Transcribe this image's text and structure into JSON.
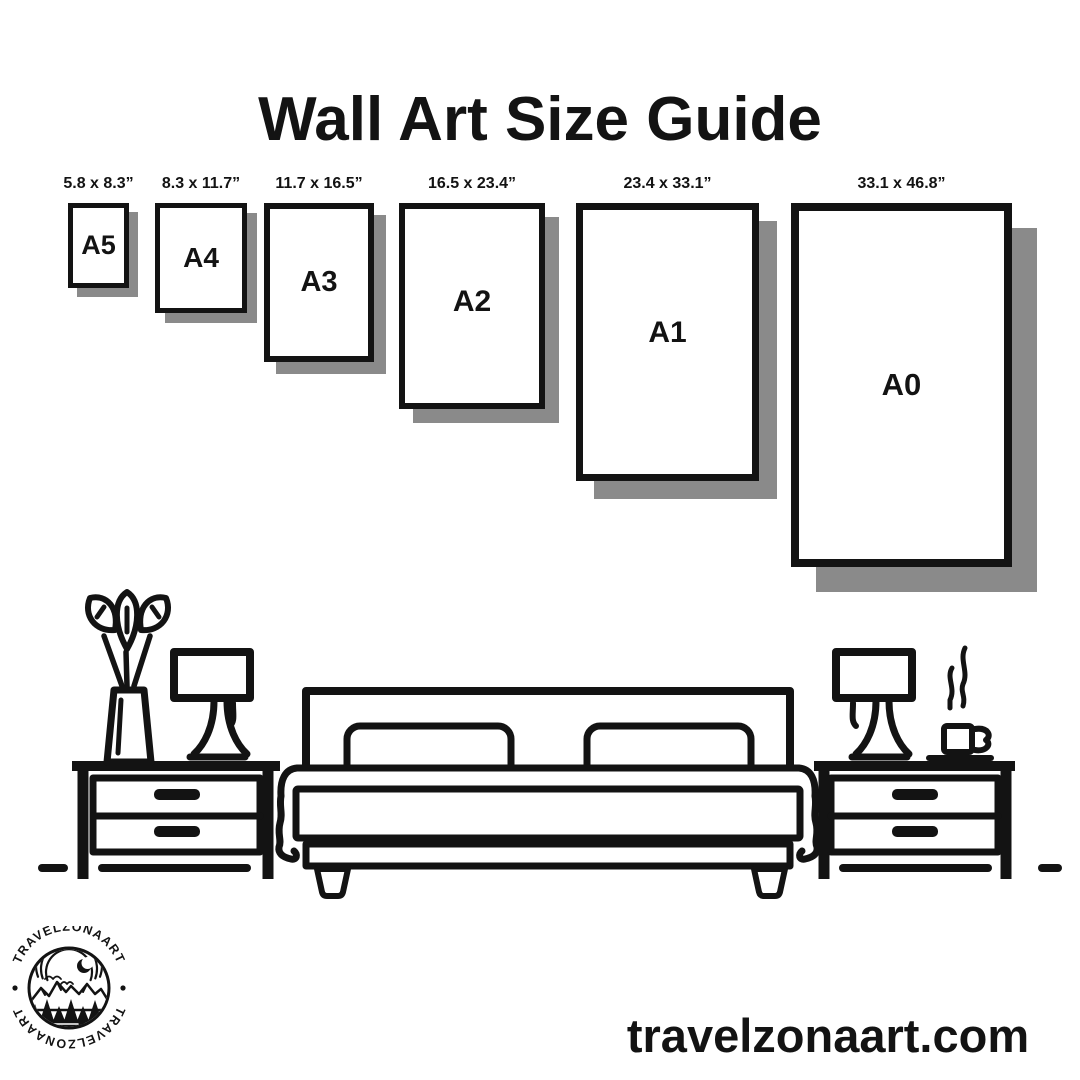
{
  "title": "Wall Art Size Guide",
  "sizes": [
    {
      "name": "A5",
      "dims": "5.8 x 8.3”"
    },
    {
      "name": "A4",
      "dims": "8.3 x 11.7”"
    },
    {
      "name": "A3",
      "dims": "11.7 x 16.5”"
    },
    {
      "name": "A2",
      "dims": "16.5 x 23.4”"
    },
    {
      "name": "A1",
      "dims": "23.4 x 33.1”"
    },
    {
      "name": "A0",
      "dims": "33.1 x 46.8”"
    }
  ],
  "logo": {
    "badge_text": "TRAVELZONAART"
  },
  "footer": {
    "website": "travelzonaart.com"
  },
  "colors": {
    "ink": "#131313",
    "shadow": "#8a8a8a",
    "background": "#ffffff"
  }
}
